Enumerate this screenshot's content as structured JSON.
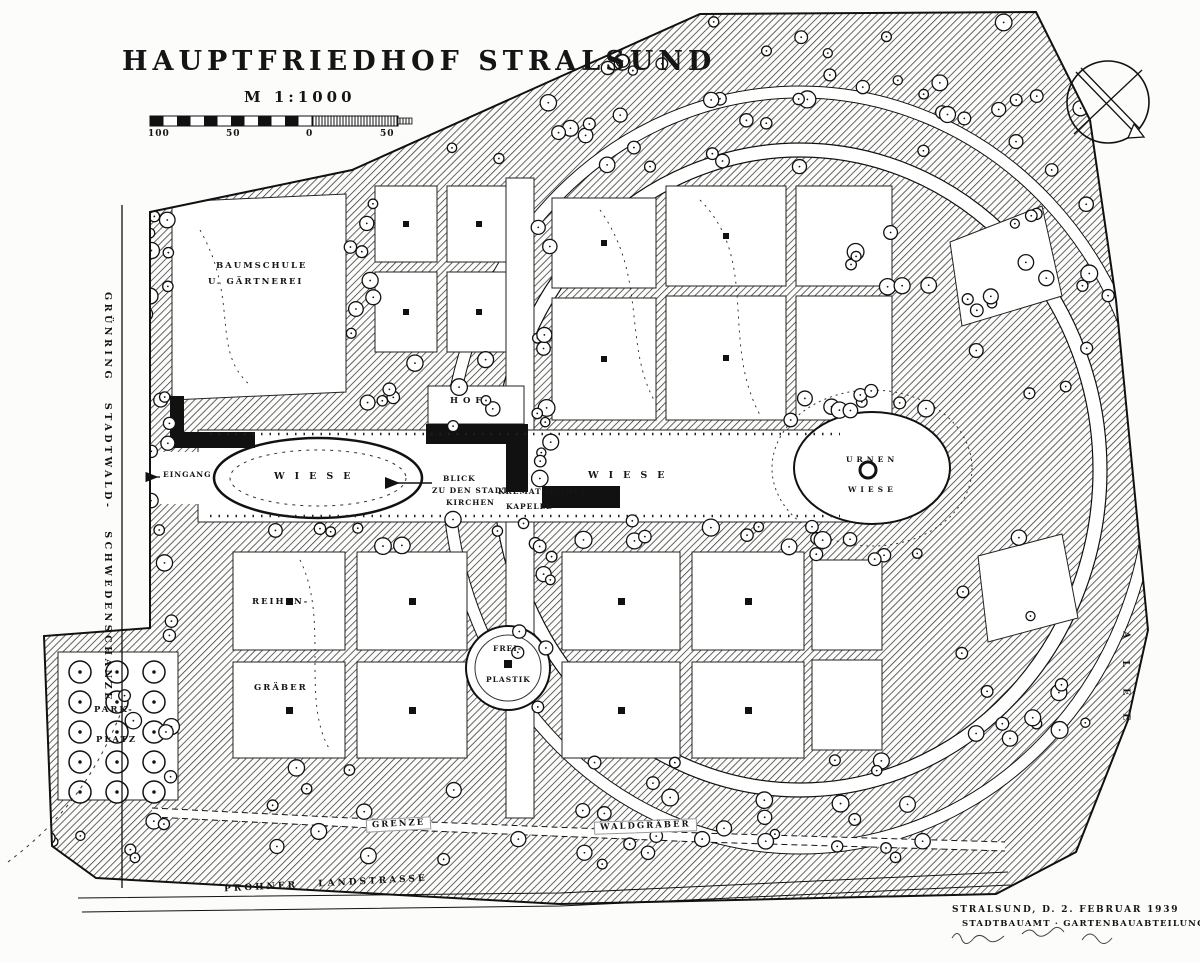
{
  "page": {
    "title": "HAUPTFRIEDHOF STRALSUND",
    "scale_label": "M 1:1000"
  },
  "scale_bar": {
    "ticks": [
      "100",
      "50",
      "0",
      "50"
    ]
  },
  "labels": {
    "green_ring": "GRÜNRING STADTWALD- SCHWEDENSCHANZE",
    "baumschule_1": "BAUMSCHULE",
    "baumschule_2": "U. GÄRTNEREI",
    "eingang": "EINGANG",
    "wiese_west": "WIESE",
    "hof": "HOF",
    "blick_1": "BLICK",
    "blick_2": "ZU DEN STADT-",
    "blick_3": "KIRCHEN",
    "krematorium_1": "KREMATORIUM U.",
    "krematorium_2": "KAPELLE",
    "wiese_mitte": "WIESE",
    "urnen_1": "URNEN",
    "urnen_2": "WIESE",
    "reihen_1": "REIHEN-",
    "reihen_2": "GRÄBER",
    "frei_1": "FREI-",
    "frei_2": "PLASTIK",
    "park_1": "PARK-",
    "park_2": "PLATZ",
    "grenze": "GRENZE",
    "waldgraeber": "WALDGRÄBER",
    "landstrasse": "PROHNER LANDSTRASSE",
    "east_letters": [
      "A",
      "L",
      "E",
      "E"
    ]
  },
  "footer": {
    "date_line": "STRALSUND, D. 2. FEBRUAR 1939",
    "office_line": "STADTBAUAMT · GARTENBAUABTEILUNG"
  },
  "icons": {
    "compass": "compass-north-icon"
  },
  "colors": {
    "ink": "#111111",
    "paper": "#fcfcfa"
  }
}
